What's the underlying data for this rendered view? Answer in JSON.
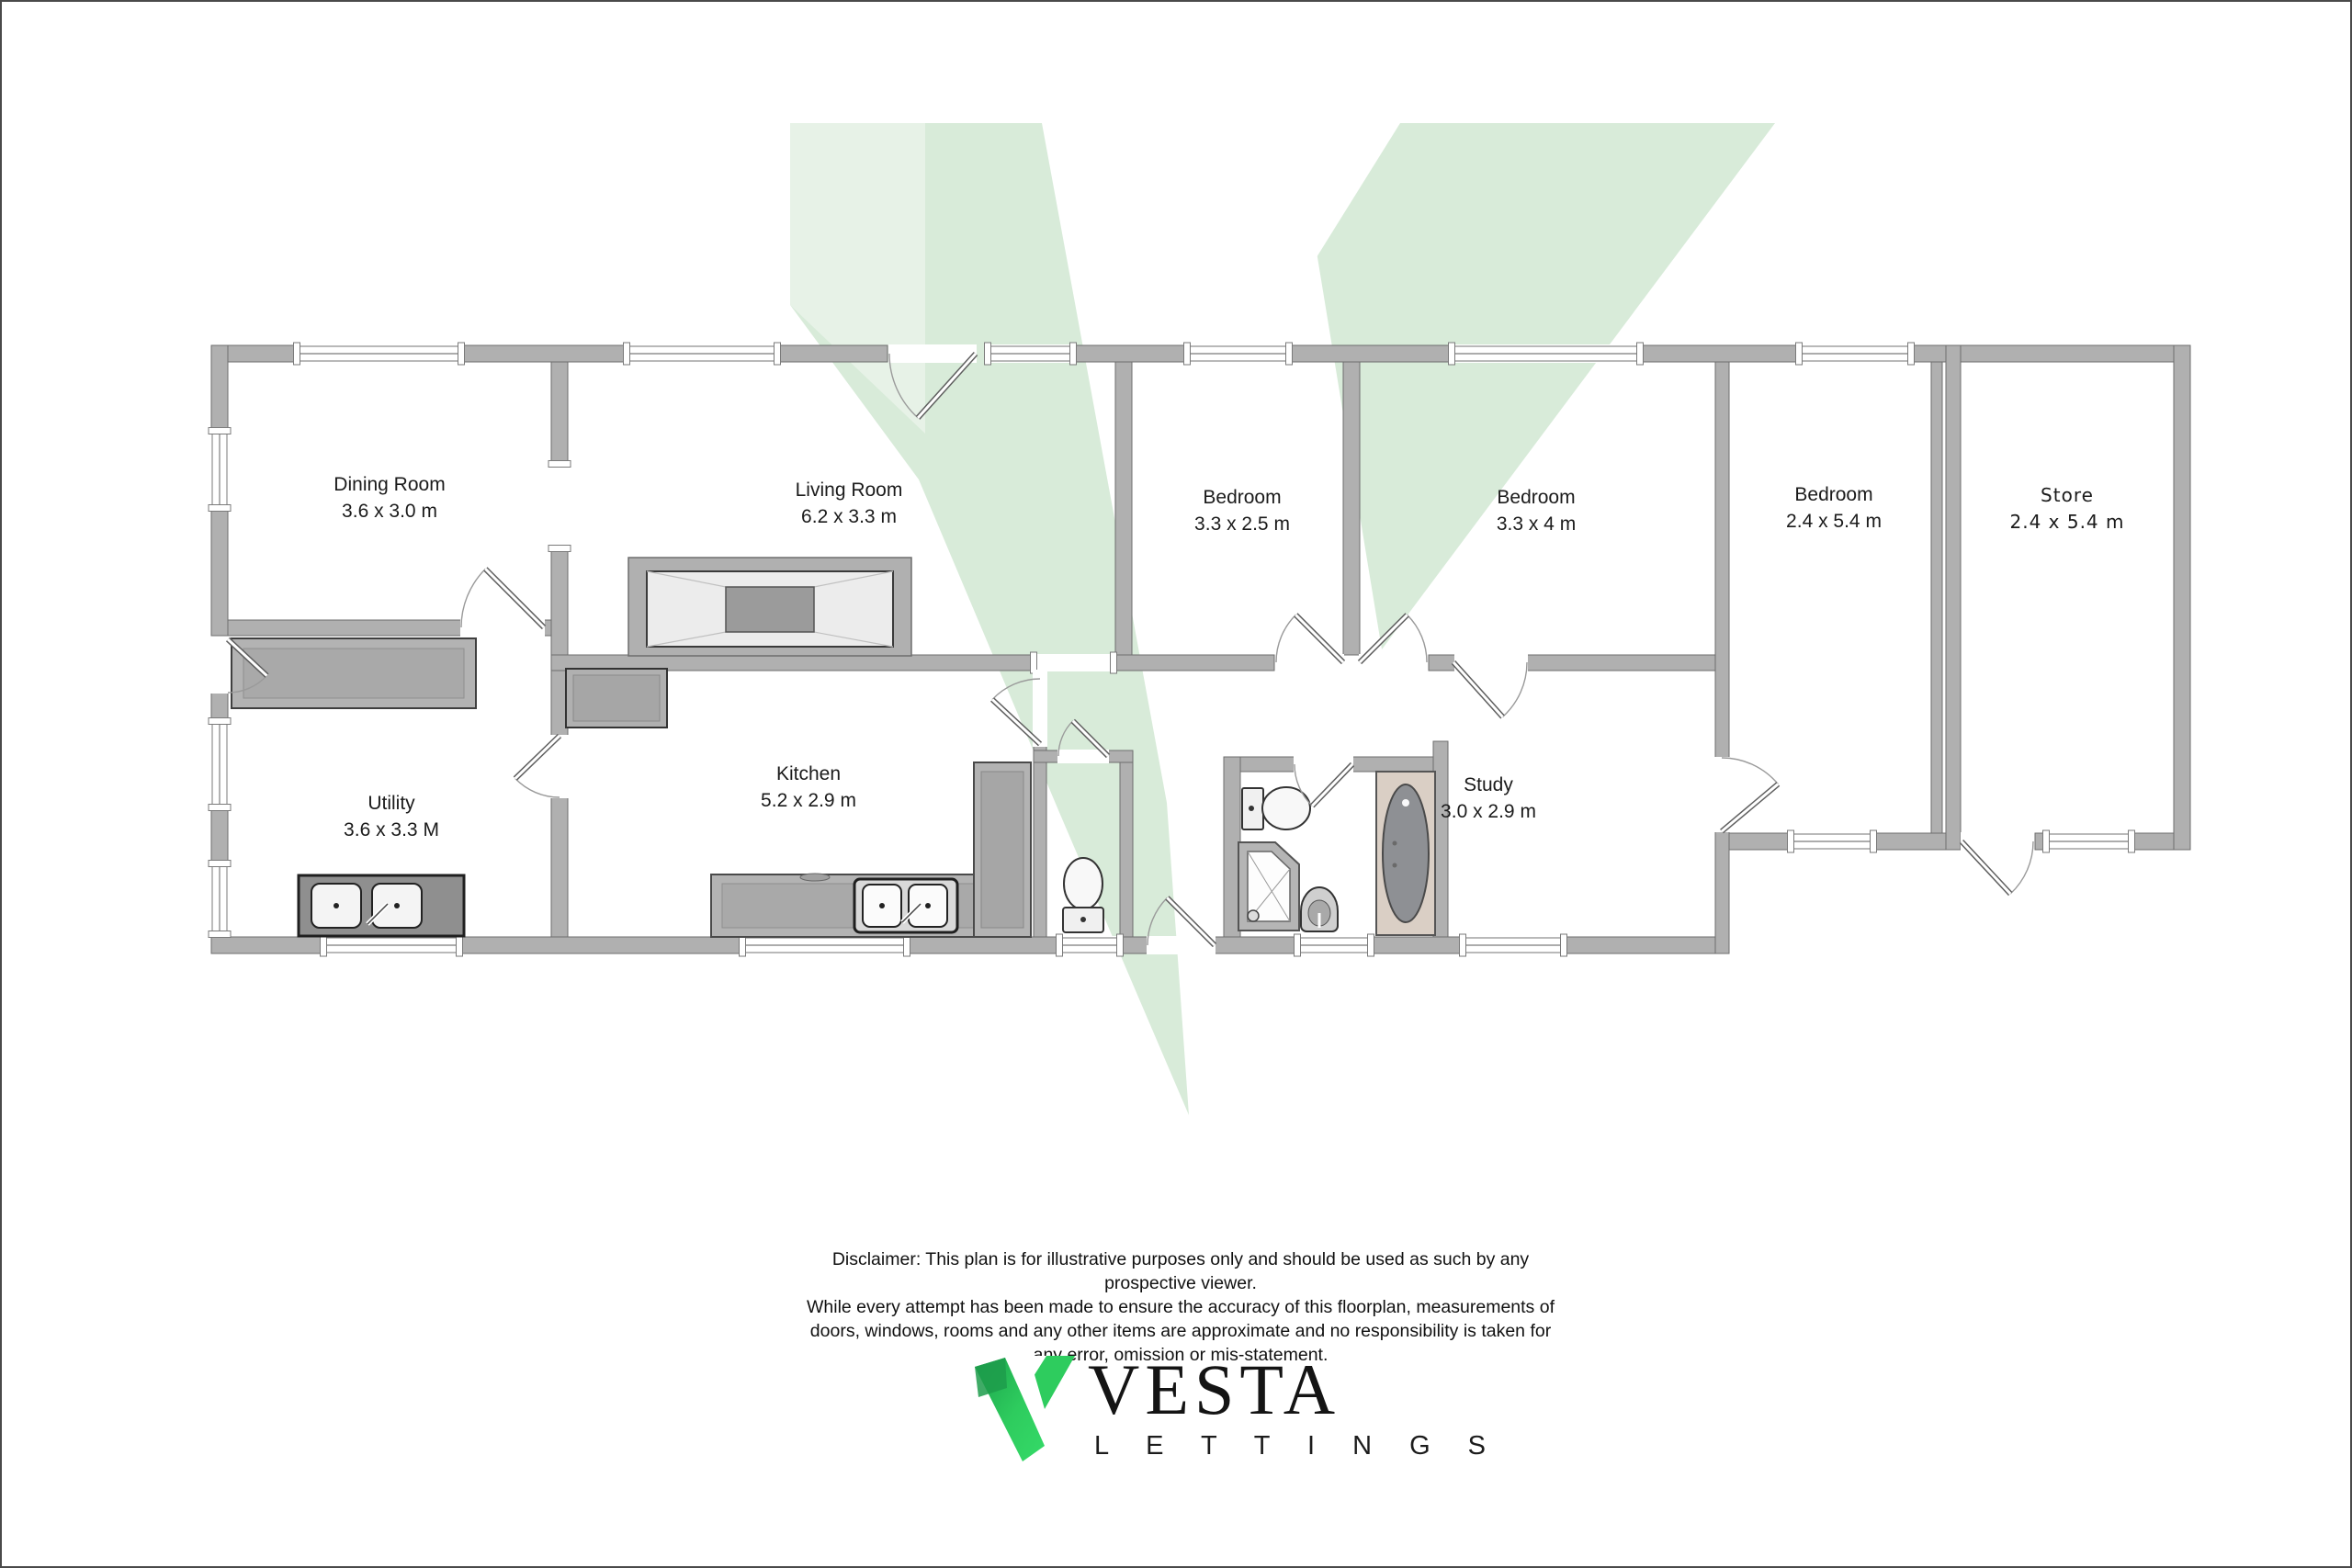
{
  "colors": {
    "wall_fill": "#b0b0b0",
    "wall_outline": "#6e6e6e",
    "watermark_green": "#d8ebd9",
    "logo_green": "#2ecc5e",
    "logo_green_dark": "#1ba14b",
    "bath_alcove": "#dacfc5",
    "text": "#1b1b1b"
  },
  "icons": {
    "watermark": "vesta-v-watermark",
    "logo_mark": "vesta-v-logo"
  },
  "rooms": [
    {
      "id": "dining",
      "name": "Dining Room",
      "dims": "3.6 x 3.0 m"
    },
    {
      "id": "living",
      "name": "Living Room",
      "dims": "6.2 x 3.3 m"
    },
    {
      "id": "bedroom1",
      "name": "Bedroom",
      "dims": "3.3 x 2.5 m"
    },
    {
      "id": "bedroom2",
      "name": "Bedroom",
      "dims": "3.3 x 4 m"
    },
    {
      "id": "bedroom3",
      "name": "Bedroom",
      "dims": "2.4 x 5.4 m"
    },
    {
      "id": "store",
      "name": "Store",
      "dims": "2.4 x 5.4 m"
    },
    {
      "id": "utility",
      "name": "Utility",
      "dims": "3.6 x 3.3 M"
    },
    {
      "id": "kitchen",
      "name": "Kitchen",
      "dims": "5.2 x 2.9 m"
    },
    {
      "id": "study",
      "name": "Study",
      "dims": "3.0 x 2.9 m"
    }
  ],
  "disclaimer": {
    "lines": [
      "Disclaimer:  This plan is for illustrative purposes only and should be used as such by any",
      "prospective viewer.",
      "While every attempt has been made to ensure the accuracy of this floorplan, measurements of",
      "doors, windows, rooms and any other items are approximate and no responsibility is taken for",
      "any error, omission or mis-statement."
    ]
  },
  "logo": {
    "brand": "VESTA",
    "division": "L E T T I N G S"
  }
}
